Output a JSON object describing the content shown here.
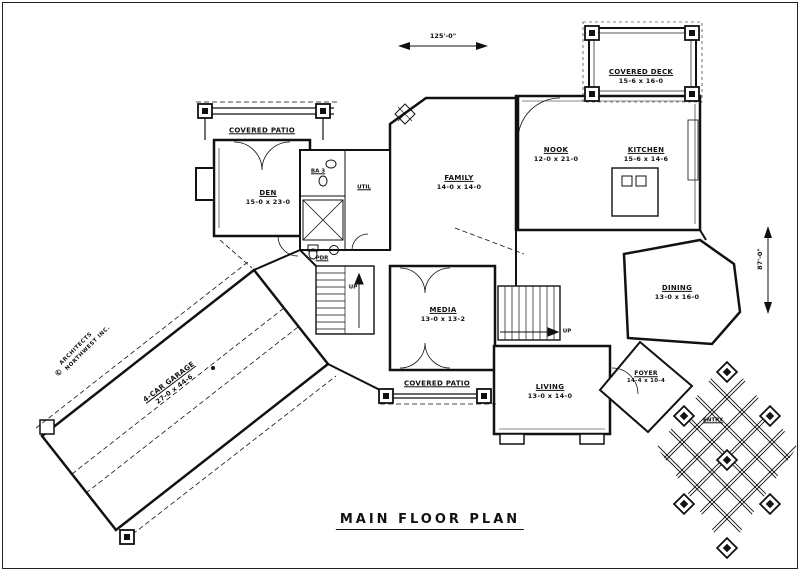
{
  "title": "MAIN FLOOR PLAN",
  "dimensions": {
    "overall_width": "125'-0\"",
    "overall_depth": "87'-0\""
  },
  "stamp": {
    "symbol": "©",
    "line1": "ARCHITECTS",
    "line2": "NORTHWEST INC."
  },
  "rooms": {
    "covered_deck": {
      "name": "COVERED DECK",
      "size": "15-6 x 16-0"
    },
    "nook": {
      "name": "NOOK",
      "size": "12-0 x 21-0"
    },
    "kitchen": {
      "name": "KITCHEN",
      "size": "15-6 x 14-6"
    },
    "family": {
      "name": "FAMILY",
      "size": "14-0 x 14-0"
    },
    "den": {
      "name": "DEN",
      "size": "15-0 x 23-0"
    },
    "media": {
      "name": "MEDIA",
      "size": "13-0 x 13-2"
    },
    "living": {
      "name": "LIVING",
      "size": "13-0 x 14-0"
    },
    "dining": {
      "name": "DINING",
      "size": "13-0 x 16-0"
    },
    "foyer": {
      "name": "FOYER",
      "size": "14-4 x 10-4"
    },
    "garage": {
      "name": "4-CAR GARAGE",
      "size": "27-0 x 44-6"
    },
    "bath3": "BA 3",
    "utility": "UTIL",
    "powder": "PDR",
    "entry": "ENTRY",
    "covered_patio_upper": "COVERED PATIO",
    "covered_patio_lower": "COVERED PATIO",
    "stair_up_left": "UP",
    "stair_up_right": "UP"
  },
  "colors": {
    "ink": "#111111",
    "paper": "#ffffff"
  }
}
